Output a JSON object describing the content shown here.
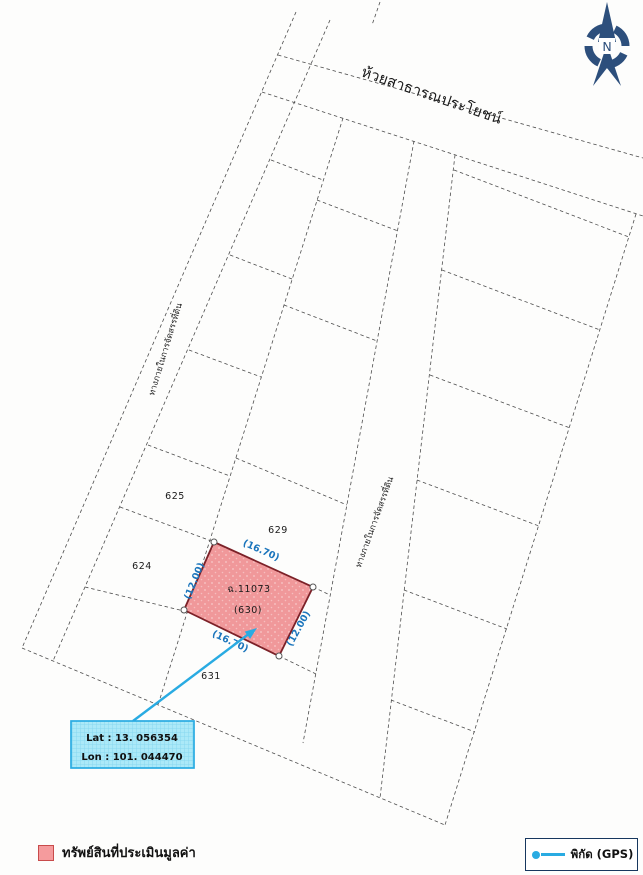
{
  "map": {
    "stream_label": "ห้วยสาธารณประโยชน์",
    "roads": {
      "internal_label": "ทางภายในการจัดสรรที่ดิน"
    },
    "compass_label": "N",
    "parcel_numbers": {
      "p625": "625",
      "p629": "629",
      "p624": "624",
      "p631": "631"
    },
    "subject": {
      "deed_no": "ฉ.11073",
      "lot_no": "(630)",
      "dim_width": "(16.70)",
      "dim_depth": "(12.00)"
    },
    "gps": {
      "lat": "Lat : 13. 056354",
      "lon": "Lon : 101. 044470"
    }
  },
  "legend": {
    "property_label": "ทรัพย์สินที่ประเมินมูลค่า",
    "gps_label": "พิกัด (GPS)"
  },
  "colors": {
    "subject_fill": "#f0989a",
    "subject_border": "#7c2128",
    "dimension_text": "#1b75bc",
    "gps_accent": "#29abe2",
    "gps_box_fill": "#abe9f8",
    "compass_navy": "#2d4f7c",
    "legend_swatch_fill": "#f59b9d",
    "legend_swatch_border": "#c84b4b"
  }
}
